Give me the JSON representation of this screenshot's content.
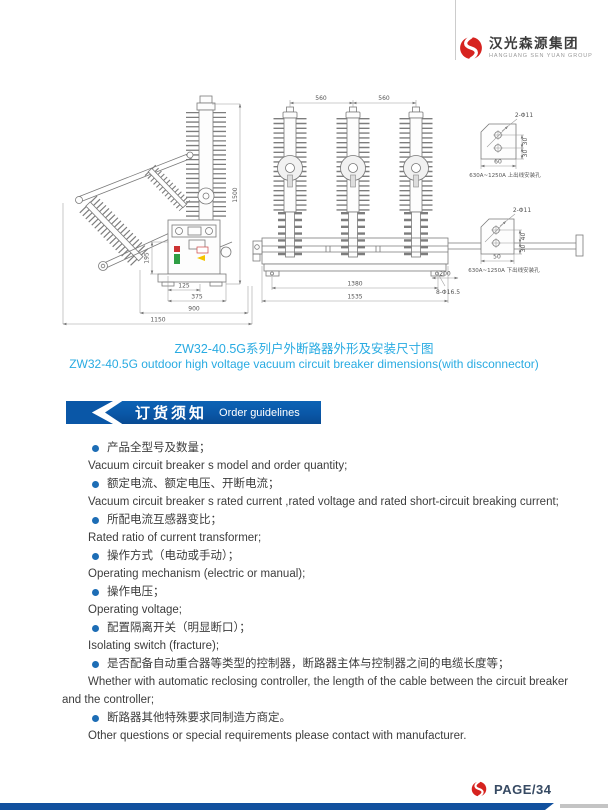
{
  "header": {
    "brand_cn": "汉光森源集团",
    "brand_en": "HANGUANG SEN YUAN GROUP"
  },
  "figure": {
    "caption_cn": "ZW32-40.5G系列户外断路器外形及安装尺寸图",
    "caption_en": "ZW32-40.5G outdoor high voltage vacuum circuit breaker dimensions(with disconnector)",
    "side_view": {
      "dim_125": "125",
      "dim_375": "375",
      "dim_900": "900",
      "dim_1150": "1150",
      "dim_195": "195",
      "dim_1500": "1500"
    },
    "front_view": {
      "dim_560_left": "560",
      "dim_560_right": "560",
      "dim_1380": "1380",
      "dim_1535": "1535",
      "dim_200": "200",
      "holes_label": "8-Φ16.5"
    },
    "detail_top": {
      "holes": "2-Φ11",
      "dim_w": "60",
      "dim_h1": "30",
      "dim_h2": "30",
      "caption": "630A~1250A 上出线安装孔"
    },
    "detail_bottom": {
      "holes": "2-Φ11",
      "dim_w": "50",
      "dim_h1": "40",
      "dim_h2": "30",
      "caption": "630A~1250A 下出线安装孔"
    }
  },
  "section": {
    "title_cn": "订货须知",
    "title_en": "Order guidelines"
  },
  "guidelines": [
    {
      "cn": "产品全型号及数量；",
      "en": "Vacuum circuit breaker s model and order quantity;"
    },
    {
      "cn": "额定电流、额定电压、开断电流；",
      "en": "Vacuum circuit breaker s rated current ,rated voltage and rated short-circuit breaking current;"
    },
    {
      "cn": "所配电流互感器变比；",
      "en": "Rated ratio of current transformer;"
    },
    {
      "cn": "操作方式（电动或手动）；",
      "en": "Operating mechanism (electric or manual);"
    },
    {
      "cn": "操作电压；",
      "en": "Operating voltage;"
    },
    {
      "cn": "配置隔离开关（明显断口）；",
      "en": "Isolating switch (fracture);"
    },
    {
      "cn": "是否配备自动重合器等类型的控制器，断路器主体与控制器之间的电缆长度等；",
      "en": "Whether with automatic reclosing controller, the length of the cable between the circuit breaker and the controller;"
    },
    {
      "cn": "断路器其他特殊要求同制造方商定。",
      "en": "Other questions or special requirements please contact with manufacturer."
    }
  ],
  "footer": {
    "page_label": "PAGE/34"
  },
  "colors": {
    "accent_blue": "#0a57a7",
    "caption_blue": "#29abe2",
    "brand_red": "#d6231f",
    "footer_bar_blue": "#11509e"
  }
}
